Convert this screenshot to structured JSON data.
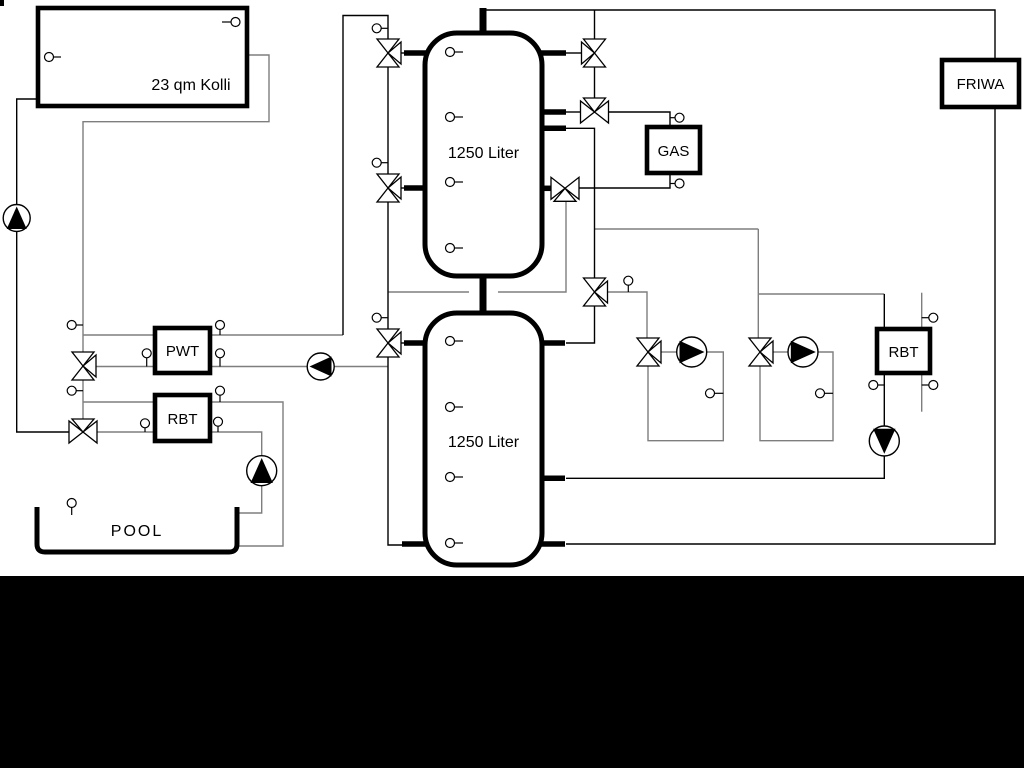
{
  "labels": {
    "collector": "23 qm Kolli",
    "tank_top": "1250 Liter",
    "tank_bottom": "1250 Liter",
    "pwt": "PWT",
    "rbt_left": "RBT",
    "gas": "GAS",
    "rbt_right": "RBT",
    "friwa": "FRIWA",
    "pool": "POOL"
  },
  "colors": {
    "line_black": "#000000",
    "line_gray": "#7e7e7e",
    "background": "#ffffff",
    "bottom_band": "#000000"
  }
}
